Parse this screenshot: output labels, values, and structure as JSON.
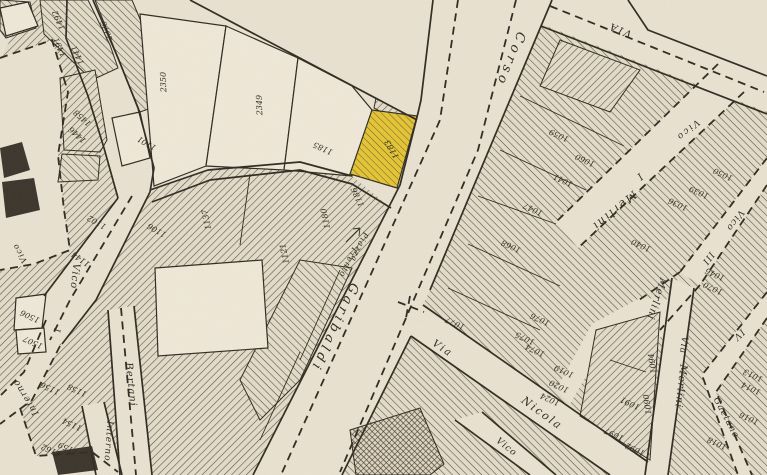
{
  "map": {
    "type": "historical-cadastral-map",
    "highlighted_parcel": {
      "number": "1183",
      "color": "#e4c434"
    },
    "colors": {
      "paper": "#e9e1d0",
      "paper_light": "#efe8d7",
      "block_bg": "#e3dbc8",
      "ink": "#2f2a20",
      "hatch": "#51493a",
      "dark_building": "#3b342b",
      "highlight": "#e4c434"
    },
    "street_labels": [
      {
        "text": "Corso",
        "x": 507,
        "y": 58,
        "rot": 112,
        "size": 13,
        "sp": 4
      },
      {
        "text": "Garibaldi",
        "x": 331,
        "y": 326,
        "rot": 115,
        "size": 13,
        "sp": 4
      },
      {
        "text": "Piazza",
        "x": 357,
        "y": 246,
        "rot": 115,
        "size": 8,
        "sp": 1
      },
      {
        "text": "Trento",
        "x": 346,
        "y": 261,
        "rot": 115,
        "size": 8,
        "sp": 1
      },
      {
        "text": "Vico",
        "x": 686,
        "y": 128,
        "rot": 140,
        "size": 9,
        "sp": 2
      },
      {
        "text": "I",
        "x": 638,
        "y": 174,
        "rot": 140,
        "size": 10,
        "sp": 0
      },
      {
        "text": "Merlini",
        "x": 612,
        "y": 208,
        "rot": 140,
        "size": 11,
        "sp": 2
      },
      {
        "text": "VIA",
        "x": 621,
        "y": 27,
        "rot": 202,
        "size": 10,
        "sp": 2
      },
      {
        "text": "Vico",
        "x": 733,
        "y": 219,
        "rot": 126,
        "size": 9,
        "sp": 1
      },
      {
        "text": "III",
        "x": 706,
        "y": 257,
        "rot": 126,
        "size": 9,
        "sp": 1
      },
      {
        "text": "Merlini",
        "x": 654,
        "y": 298,
        "rot": 108,
        "size": 10,
        "sp": 1
      },
      {
        "text": "Via",
        "x": 681,
        "y": 345,
        "rot": 97,
        "size": 9,
        "sp": 1
      },
      {
        "text": "Merlini",
        "x": 678,
        "y": 386,
        "rot": 97,
        "size": 10,
        "sp": 1
      },
      {
        "text": "IV",
        "x": 737,
        "y": 333,
        "rot": 135,
        "size": 9,
        "sp": 1
      },
      {
        "text": "Gaetano",
        "x": 724,
        "y": 419,
        "rot": 62,
        "size": 9,
        "sp": 1
      },
      {
        "text": "Via",
        "x": 441,
        "y": 351,
        "rot": 34,
        "size": 10,
        "sp": 2
      },
      {
        "text": "Nicola",
        "x": 540,
        "y": 416,
        "rot": 36,
        "size": 11,
        "sp": 2
      },
      {
        "text": "Vico",
        "x": 505,
        "y": 449,
        "rot": 38,
        "size": 9,
        "sp": 1
      },
      {
        "text": "Vico",
        "x": 72,
        "y": 276,
        "rot": 96,
        "size": 10,
        "sp": 1
      },
      {
        "text": "I",
        "x": 54,
        "y": 330,
        "rot": 96,
        "size": 9,
        "sp": 0
      },
      {
        "text": "Vico",
        "x": 22,
        "y": 252,
        "rot": 240,
        "size": 8,
        "sp": 1
      },
      {
        "text": "Bertani",
        "x": 128,
        "y": 385,
        "rot": 84,
        "size": 10,
        "sp": 1
      },
      {
        "text": "Interno",
        "x": 28,
        "y": 396,
        "rot": 238,
        "size": 9,
        "sp": 1
      },
      {
        "text": "Interno",
        "x": 106,
        "y": 441,
        "rot": 94,
        "size": 9,
        "sp": 1
      }
    ],
    "parcel_numbers": [
      {
        "n": "2350",
        "x": 166,
        "y": 82,
        "rot": 268
      },
      {
        "n": "2349",
        "x": 262,
        "y": 105,
        "rot": 268
      },
      {
        "n": "2376",
        "x": 109,
        "y": 30,
        "rot": 250
      },
      {
        "n": "1492",
        "x": 61,
        "y": 19,
        "rot": 245
      },
      {
        "n": "1491",
        "x": 62,
        "y": 46,
        "rot": 245
      },
      {
        "n": "1441",
        "x": 80,
        "y": 54,
        "rot": 245
      },
      {
        "n": "1458",
        "x": 84,
        "y": 116,
        "rot": 222
      },
      {
        "n": "1446",
        "x": 79,
        "y": 133,
        "rot": 222
      },
      {
        "n": "1185",
        "x": 324,
        "y": 146,
        "rot": 205
      },
      {
        "n": "1183",
        "x": 394,
        "y": 148,
        "rot": 240
      },
      {
        "n": "1186",
        "x": 360,
        "y": 196,
        "rot": 245
      },
      {
        "n": "1101",
        "x": 148,
        "y": 141,
        "rot": 210
      },
      {
        "n": "1102",
        "x": 98,
        "y": 220,
        "rot": 210
      },
      {
        "n": "1106",
        "x": 158,
        "y": 228,
        "rot": 210
      },
      {
        "n": "1137",
        "x": 209,
        "y": 219,
        "rot": 258
      },
      {
        "n": "1121",
        "x": 287,
        "y": 253,
        "rot": 258
      },
      {
        "n": "1180",
        "x": 328,
        "y": 218,
        "rot": 258
      },
      {
        "n": "1144",
        "x": 82,
        "y": 257,
        "rot": 215
      },
      {
        "n": "1506",
        "x": 31,
        "y": 314,
        "rot": 205
      },
      {
        "n": "1507",
        "x": 34,
        "y": 340,
        "rot": 205
      },
      {
        "n": "1156",
        "x": 51,
        "y": 386,
        "rot": 205
      },
      {
        "n": "1158",
        "x": 78,
        "y": 388,
        "rot": 205
      },
      {
        "n": "1154",
        "x": 73,
        "y": 422,
        "rot": 205
      },
      {
        "n": "1159",
        "x": 69,
        "y": 446,
        "rot": 205
      },
      {
        "n": "1162",
        "x": 52,
        "y": 448,
        "rot": 205
      },
      {
        "n": "1059",
        "x": 560,
        "y": 133,
        "rot": 205
      },
      {
        "n": "1060",
        "x": 586,
        "y": 158,
        "rot": 205
      },
      {
        "n": "1041",
        "x": 564,
        "y": 178,
        "rot": 205
      },
      {
        "n": "1047",
        "x": 534,
        "y": 207,
        "rot": 205
      },
      {
        "n": "1068",
        "x": 512,
        "y": 244,
        "rot": 205
      },
      {
        "n": "1050",
        "x": 724,
        "y": 172,
        "rot": 205
      },
      {
        "n": "1039",
        "x": 700,
        "y": 190,
        "rot": 205
      },
      {
        "n": "1036",
        "x": 679,
        "y": 202,
        "rot": 205
      },
      {
        "n": "1040",
        "x": 642,
        "y": 243,
        "rot": 205
      },
      {
        "n": "1046",
        "x": 716,
        "y": 272,
        "rot": 205
      },
      {
        "n": "1070",
        "x": 714,
        "y": 286,
        "rot": 205
      },
      {
        "n": "1077",
        "x": 456,
        "y": 321,
        "rot": 205
      },
      {
        "n": "1076",
        "x": 541,
        "y": 317,
        "rot": 205
      },
      {
        "n": "1075",
        "x": 526,
        "y": 336,
        "rot": 205
      },
      {
        "n": "1074",
        "x": 536,
        "y": 348,
        "rot": 205
      },
      {
        "n": "1019",
        "x": 565,
        "y": 369,
        "rot": 205
      },
      {
        "n": "1020",
        "x": 560,
        "y": 384,
        "rot": 205
      },
      {
        "n": "1024",
        "x": 551,
        "y": 397,
        "rot": 205
      },
      {
        "n": "1094",
        "x": 655,
        "y": 363,
        "rot": 262
      },
      {
        "n": "1090",
        "x": 650,
        "y": 404,
        "rot": 262
      },
      {
        "n": "1091",
        "x": 631,
        "y": 401,
        "rot": 205
      },
      {
        "n": "1097",
        "x": 615,
        "y": 432,
        "rot": 205
      },
      {
        "n": "1092",
        "x": 636,
        "y": 447,
        "rot": 205
      },
      {
        "n": "1013",
        "x": 754,
        "y": 373,
        "rot": 205
      },
      {
        "n": "1014",
        "x": 752,
        "y": 386,
        "rot": 205
      },
      {
        "n": "1016",
        "x": 750,
        "y": 416,
        "rot": 205
      },
      {
        "n": "1018",
        "x": 718,
        "y": 441,
        "rot": 205
      }
    ],
    "geometry": {
      "land": [
        {
          "pts": "30,0 433,0 421,100 418,113 400,185 253,475 40,475 0,440 0,60",
          "p": "A"
        },
        {
          "pts": "541,24 767,112 767,475 342,475 411,336 423,305 430,290",
          "p": "B"
        }
      ],
      "paper_overlays": [
        {
          "pts": "0,58 52,40 68,92 58,155 64,210 70,250 34,264 0,270"
        },
        {
          "pts": "67,0 93,0 118,58 138,108 154,168 150,192 118,198 104,148 88,96 66,38"
        },
        {
          "pts": "118,198 150,192 96,300 62,344 38,342 44,296"
        },
        {
          "pts": "46,320 60,346 32,400 0,424 0,396 24,372"
        },
        {
          "pts": "108,310 134,306 152,475 120,475"
        },
        {
          "pts": "82,406 104,402 122,475 96,475"
        },
        {
          "pts": "0,425 20,408 36,456 92,452 118,472 118,475 0,475"
        },
        {
          "pts": "93,0 190,0 417,120 400,185 391,208 352,176 300,162 208,170 150,190 154,168 138,108 118,58"
        },
        {
          "pts": "190,0 433,0 421,100 417,122"
        },
        {
          "pts": "718,64 744,92 578,248 556,222"
        },
        {
          "pts": "767,158 767,185 700,285 680,272"
        },
        {
          "pts": "694,288 672,278 645,475 668,475"
        },
        {
          "pts": "767,292 702,375 738,475 752,475 716,392 767,318"
        },
        {
          "pts": "423,305 648,462 660,475 610,475 411,336"
        },
        {
          "pts": "455,420 482,412 556,475 530,475"
        },
        {
          "pts": "592,324 640,298 678,300 672,330 640,350 600,352 570,404 556,390"
        }
      ],
      "hatch_patches": [
        {
          "pts": "40,0 88,0 110,45 118,68 92,80 44,34",
          "p": "B"
        },
        {
          "pts": "60,78 95,70 107,140 100,152 64,150",
          "p": "A"
        },
        {
          "pts": "62,154 100,156 98,180 58,182",
          "p": "B"
        },
        {
          "pts": "95,0 132,0 158,62 168,102 140,112 117,55",
          "p": "B"
        },
        {
          "pts": "376,98 412,118 396,120 374,108",
          "p": "A"
        },
        {
          "pts": "350,430 420,408 444,464 430,475 356,475",
          "p": "D"
        },
        {
          "pts": "560,40 640,70 610,112 540,86",
          "p": "A"
        },
        {
          "pts": "596,330 660,312 650,460 580,416",
          "p": "A"
        },
        {
          "pts": "300,260 352,268 300,380 260,420 240,380",
          "p": "B"
        },
        {
          "pts": "0,0 30,2 36,28 6,38 0,30",
          "p": "B"
        }
      ],
      "white_parcels": [
        {
          "pts": "140,14 226,26 206,166 154,186"
        },
        {
          "pts": "226,26 298,58 284,170 206,166"
        },
        {
          "pts": "298,58 352,86 372,110 352,176 284,170"
        },
        {
          "pts": "155,268 262,260 268,348 158,356"
        },
        {
          "pts": "16,298 46,294 42,328 14,330"
        },
        {
          "pts": "16,330 44,328 46,352 18,354"
        },
        {
          "pts": "0,8 28,2 38,26 6,36"
        },
        {
          "pts": "112,118 140,112 150,158 122,166"
        }
      ],
      "dark_shapes": [
        {
          "pts": "0,148 22,142 30,170 4,178"
        },
        {
          "pts": "2,182 34,178 40,210 6,218"
        },
        {
          "pts": "52,452 92,446 98,470 58,475"
        }
      ],
      "solid_lines": [
        {
          "pts": "433,0 421,100 418,113 400,185 253,475"
        },
        {
          "pts": "552,0 430,290"
        },
        {
          "pts": "411,336 342,475"
        },
        {
          "pts": "423,305 648,462"
        },
        {
          "pts": "411,336 610,475"
        },
        {
          "pts": "541,26 767,114"
        },
        {
          "pts": "628,0 648,30 767,76"
        },
        {
          "pts": "67,0 66,38 88,96 104,148 118,198"
        },
        {
          "pts": "93,0 118,58 138,108 154,168 150,192"
        },
        {
          "pts": "44,296 118,198"
        },
        {
          "pts": "150,192 96,300 62,344"
        },
        {
          "pts": "108,310 120,475"
        },
        {
          "pts": "134,306 152,475"
        },
        {
          "pts": "82,406 96,475"
        },
        {
          "pts": "104,402 122,475"
        },
        {
          "pts": "190,0 417,120"
        },
        {
          "pts": "150,190 208,170 300,162 352,176"
        },
        {
          "pts": "152,202 210,180 300,170 352,184 391,208"
        },
        {
          "pts": "672,278 645,475"
        },
        {
          "pts": "694,288 668,475"
        },
        {
          "pts": "455,420 530,475"
        },
        {
          "pts": "482,412 556,475"
        }
      ],
      "thin_lines": [
        {
          "pts": "520,96 624,146"
        },
        {
          "pts": "500,150 586,190"
        },
        {
          "pts": "478,196 556,224"
        },
        {
          "pts": "468,244 560,286"
        },
        {
          "pts": "448,288 540,330"
        },
        {
          "pts": "250,174 240,245"
        },
        {
          "pts": "340,270 300,360"
        },
        {
          "pts": "300,352 260,440"
        },
        {
          "pts": "610,360 646,372"
        },
        {
          "pts": "346,242 360,228"
        },
        {
          "pts": "360,228 353,229"
        },
        {
          "pts": "360,228 359,236"
        }
      ],
      "dashed_lines": [
        {
          "pts": "458,0 440,120 281,475"
        },
        {
          "pts": "516,0 478,150 340,472"
        },
        {
          "pts": "398,302 424,312"
        },
        {
          "pts": "410,296 406,318"
        },
        {
          "pts": "550,6 764,92"
        },
        {
          "pts": "718,64 556,222"
        },
        {
          "pts": "744,92 578,248"
        },
        {
          "pts": "767,158 680,272"
        },
        {
          "pts": "767,185 700,285"
        },
        {
          "pts": "680,272 636,302"
        },
        {
          "pts": "700,285 660,330"
        },
        {
          "pts": "767,292 702,375 738,475"
        },
        {
          "pts": "767,318 716,392 752,475"
        },
        {
          "pts": "121,308 136,475"
        },
        {
          "pts": "132,196 70,300 50,340"
        },
        {
          "pts": "46,320 24,372 0,396"
        },
        {
          "pts": "60,346 32,400 0,424"
        },
        {
          "pts": "0,58 52,40 68,92 58,155 64,210 70,250 34,264 0,270"
        },
        {
          "pts": "20,408 36,456 92,452 118,472"
        }
      ],
      "highlight_parcel": {
        "pts": "372,110 417,116 397,188 350,174"
      }
    }
  }
}
